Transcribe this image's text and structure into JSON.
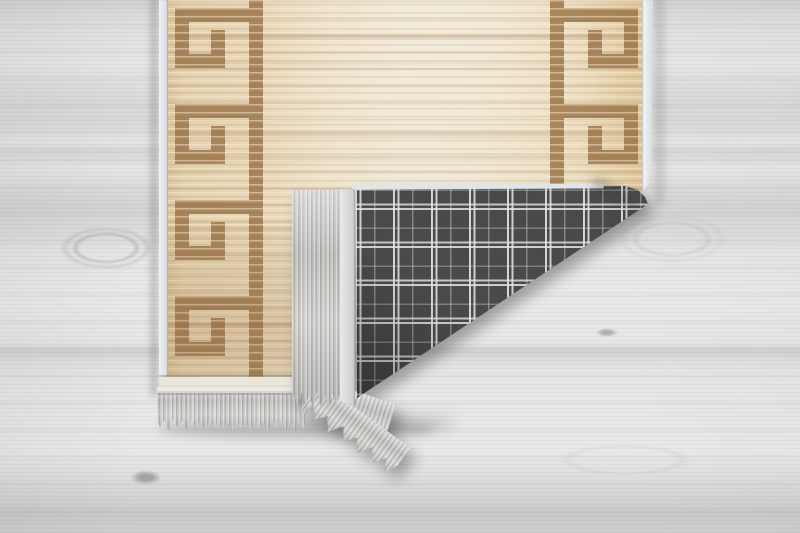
{
  "scene": {
    "type": "product photo",
    "description": "Beige runner rug with brown Greek key meander border hanging over a light gray wood-plank floor; its bottom-right corner is folded over, revealing a dark gray windowpane-plaid woven backing, a pale binding hem and light gray fringe tassels along the folded edge and the bottom edge.",
    "text_content_visible": "none"
  },
  "colors": {
    "--floor-base": "#e6e6e6",
    "--rug-cream": "#efe4cd",
    "--rug-tan": "#dcbf94",
    "--key-brown": "#9b7447",
    "--binding-white": "#eef0f2",
    "--plaid-base": "#474747",
    "--plaid-line": "#dcdcdc",
    "--fringe-light": "#dddcd9",
    "--fringe-dark": "#b0afac",
    "--hem": "#eae6dc"
  },
  "elements": {
    "floor": "light gray wood plank floor with grain streaks and knots",
    "rug_front": "beige rug face with horizontal striated texture",
    "greek_key_border_left": "brown Greek key meander border, left edge",
    "greek_key_border_right": "brown Greek key meander border, right edge (mirrored)",
    "binding_left": "white serged edge binding, left side",
    "binding_right": "white serged edge binding, right side",
    "hem": "pale hem band above bottom fringe",
    "front_fringe": "light gray knotted fringe tassels along bottom edge",
    "flap": "folded-over bottom-right corner of rug",
    "flap_fringe": "fringe hanging from the folded edge",
    "flap_binding": "light gray hem binding of folded edge",
    "plaid_backing": "dark gray tartan check rug backing",
    "shadow": "soft drop shadows cast on floor"
  }
}
